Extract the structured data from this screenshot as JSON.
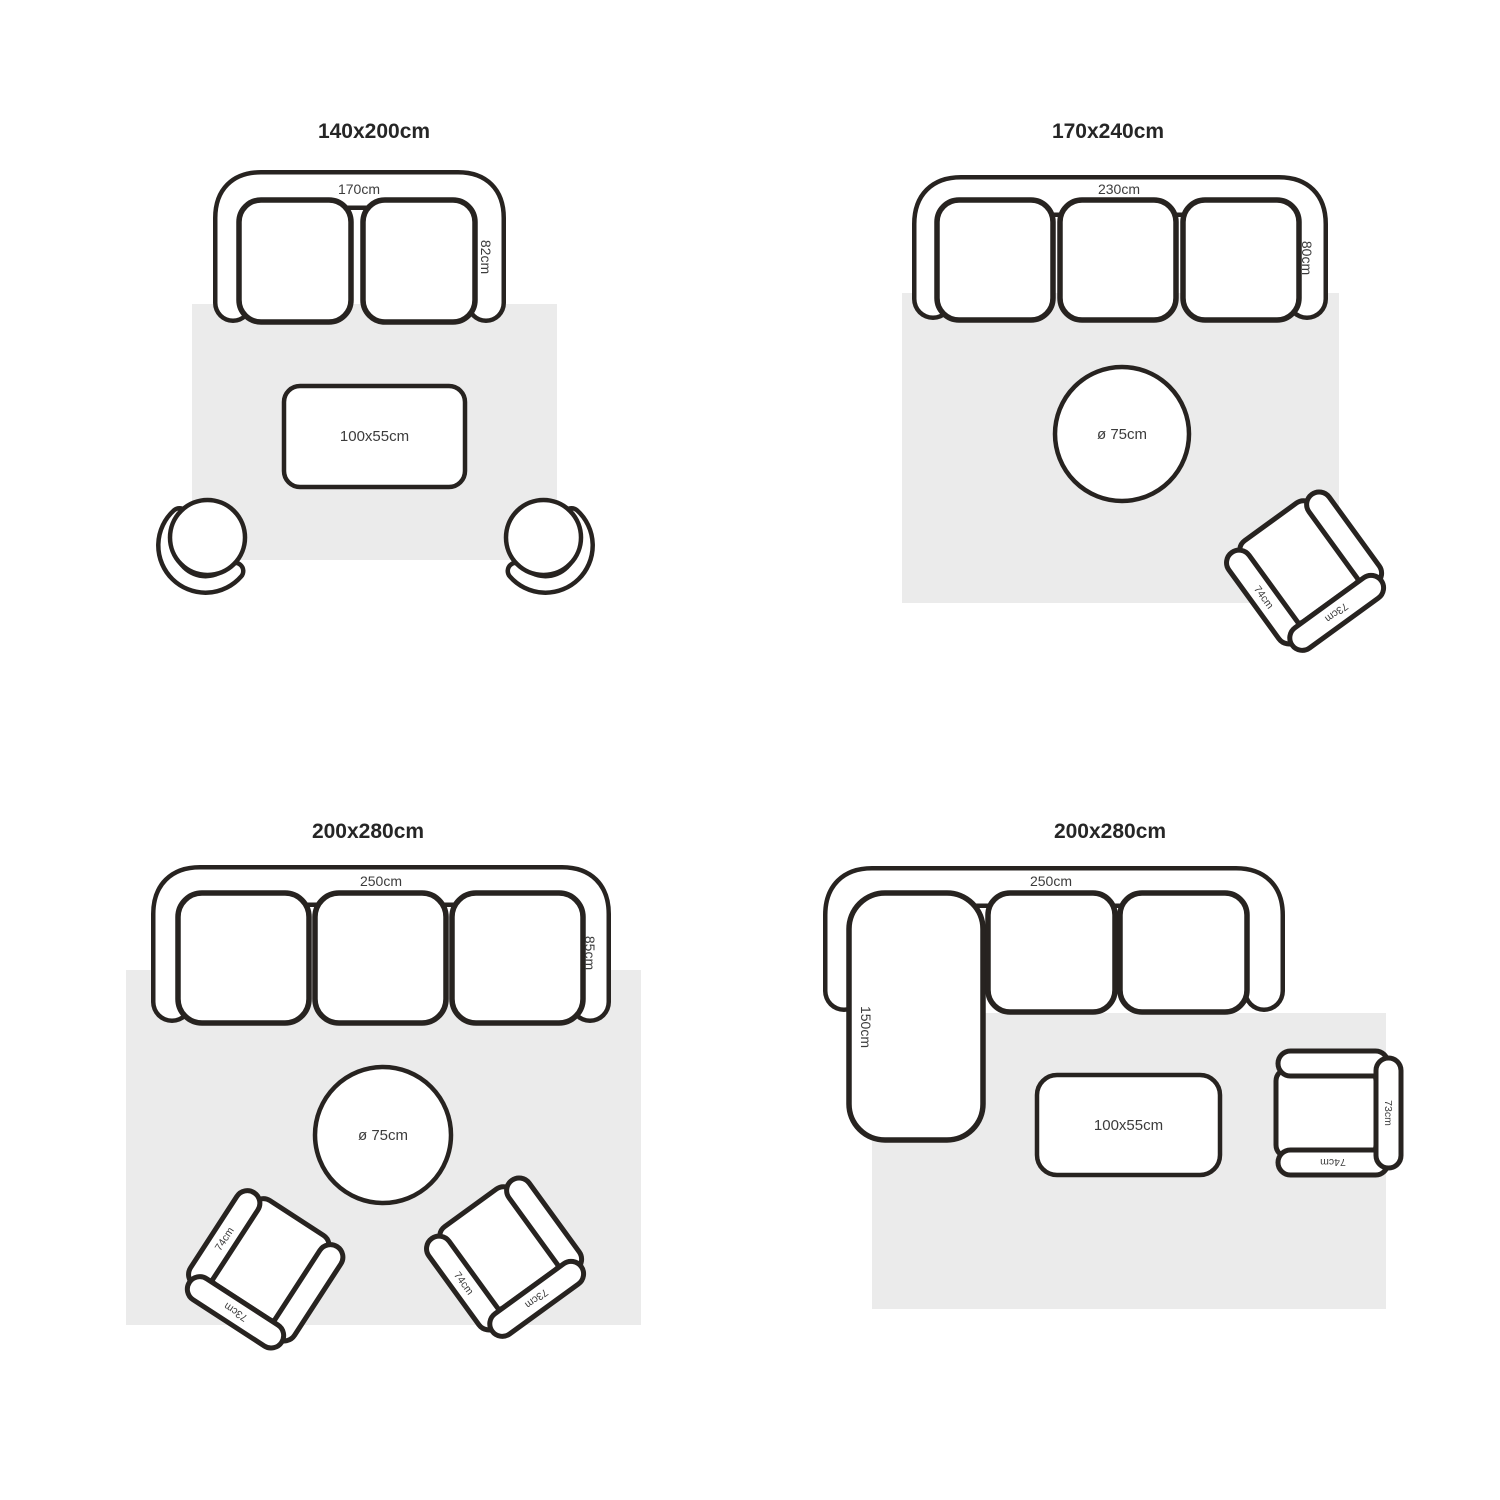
{
  "page": {
    "background_color": "#ffffff",
    "line_color": "#272320",
    "rug_color": "#ebebeb",
    "text_color": "#3c3c3c"
  },
  "quadrants": [
    {
      "title": "140x200cm",
      "sofa": {
        "type": "2-seat sofa",
        "width_label": "170cm",
        "depth_label": "82cm"
      },
      "table": {
        "type": "rectangular coffee table",
        "label": "100x55cm"
      },
      "poufs": [
        {
          "name": "tub chair left"
        },
        {
          "name": "tub chair right"
        }
      ]
    },
    {
      "title": "170x240cm",
      "sofa": {
        "type": "3-seat sofa",
        "width_label": "230cm",
        "depth_label": "80cm"
      },
      "table": {
        "type": "round coffee table",
        "label": "ø 75cm"
      },
      "chairs": [
        {
          "arm_label": "74cm",
          "back_label": "73cm"
        }
      ]
    },
    {
      "title": "200x280cm",
      "sofa": {
        "type": "3-seat sofa",
        "width_label": "250cm",
        "depth_label": "85cm"
      },
      "table": {
        "type": "round coffee table",
        "label": "ø 75cm"
      },
      "chairs": [
        {
          "arm_label": "74cm",
          "back_label": "73cm"
        },
        {
          "arm_label": "74cm",
          "back_label": "73cm"
        }
      ]
    },
    {
      "title": "200x280cm",
      "sofa": {
        "type": "sectional sofa with chaise",
        "width_label": "250cm",
        "chaise_label": "150cm"
      },
      "table": {
        "type": "rectangular coffee table",
        "label": "100x55cm"
      },
      "chairs": [
        {
          "arm_label": "74cm",
          "back_label": "73cm"
        }
      ]
    }
  ]
}
